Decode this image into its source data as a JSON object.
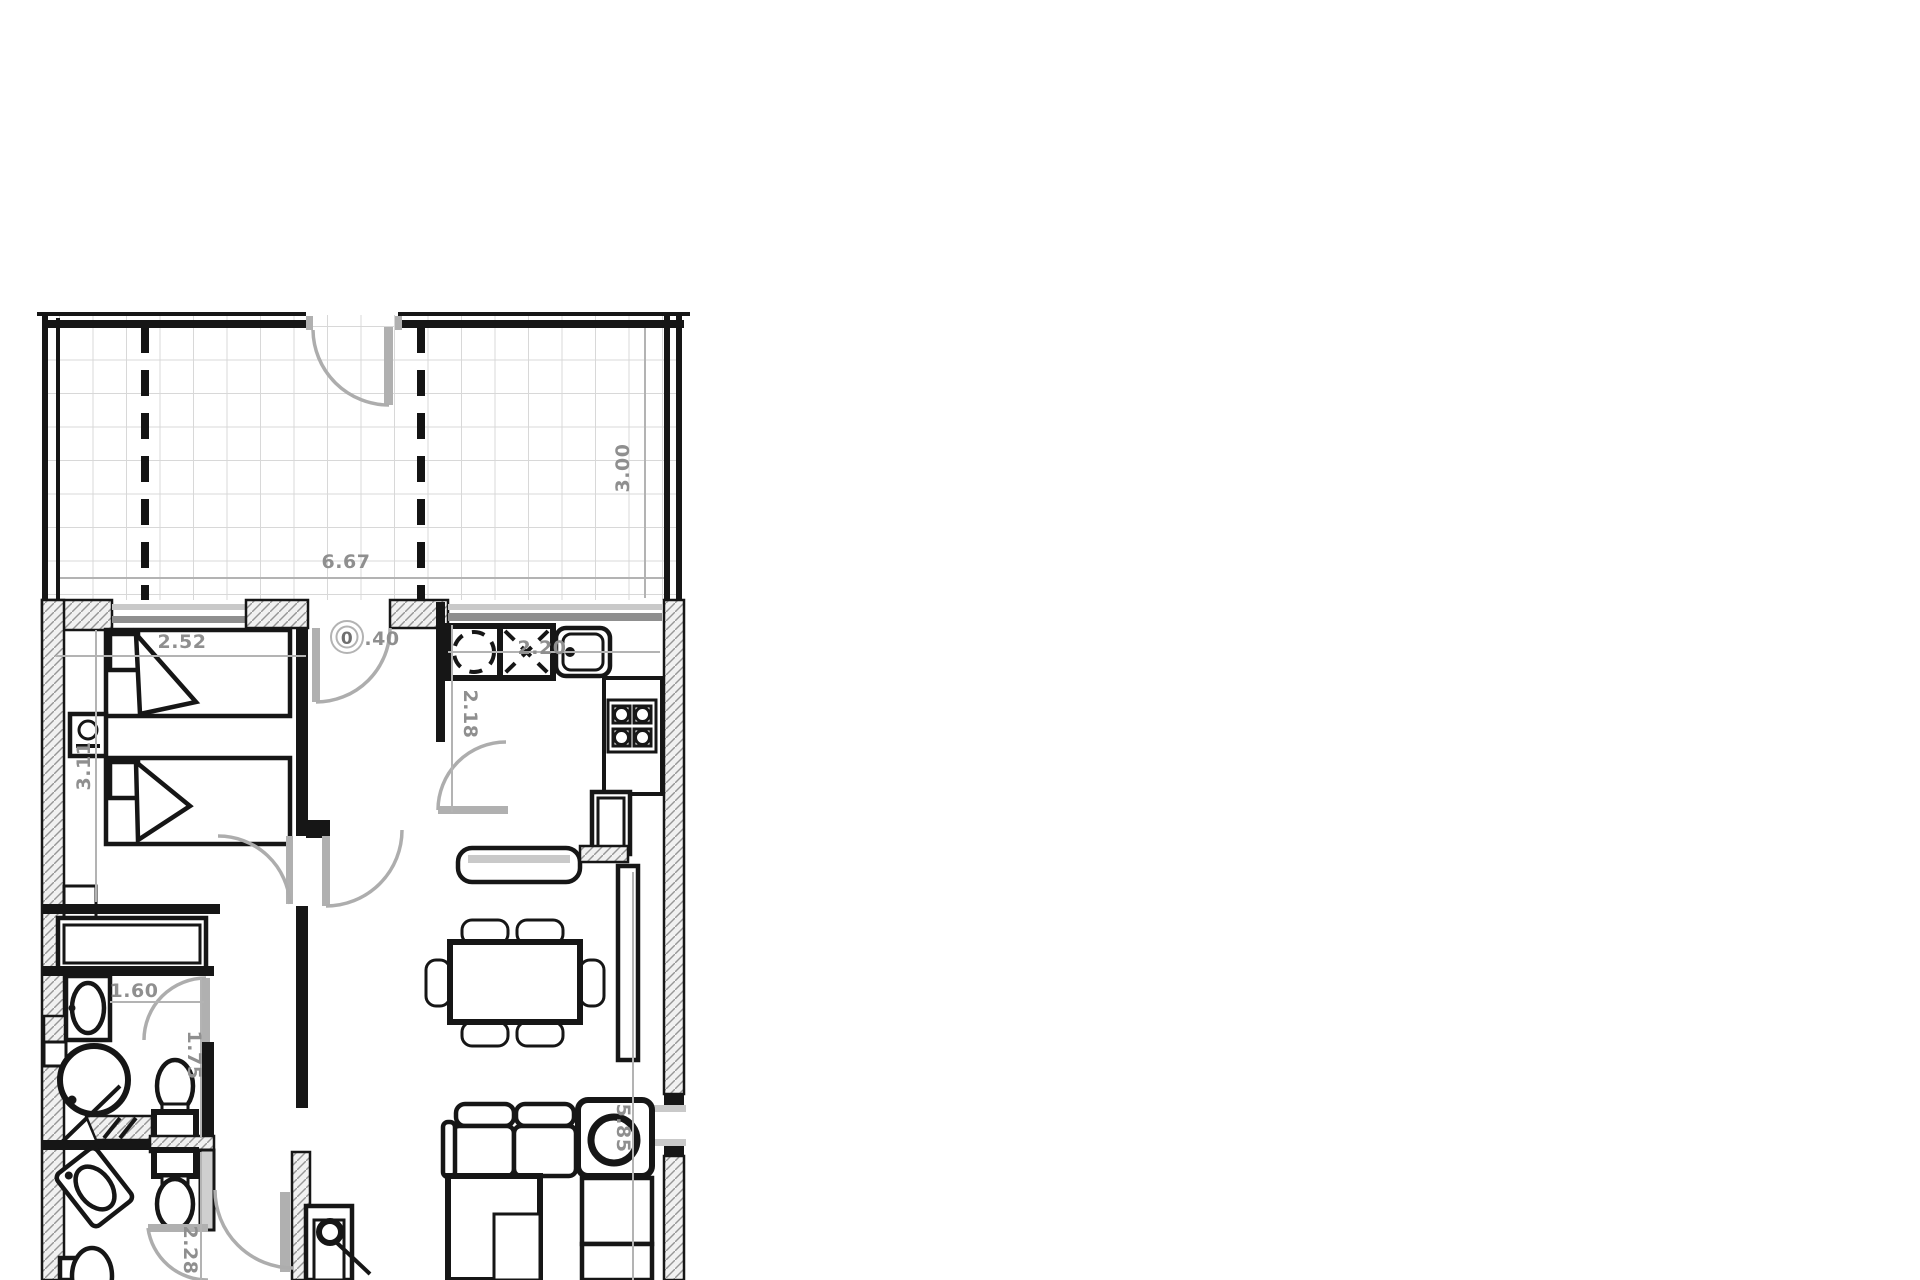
{
  "plan": {
    "type": "apartment-floor-plan",
    "dimensions": {
      "terrace_width": "6.67",
      "terrace_depth": "3.00",
      "bedroom_width": "2.52",
      "bedroom_depth": "3.11",
      "hall_marker_zero": "0",
      "hall_marker_rest": ".40",
      "kitchen_width": "2.20",
      "kitchen_depth": "2.18",
      "bathroom_width": "1.60",
      "bathroom_depth": "1.75",
      "bathroom2_depth": "2.28",
      "living_depth": "5.85"
    },
    "colors": {
      "wall": "#161616",
      "dimension_text": "#8f8f8f",
      "glass": "#9e9e9e",
      "door": "#b0b0b0",
      "tile_line": "#d8d8d8",
      "hatch": "#969696"
    }
  }
}
